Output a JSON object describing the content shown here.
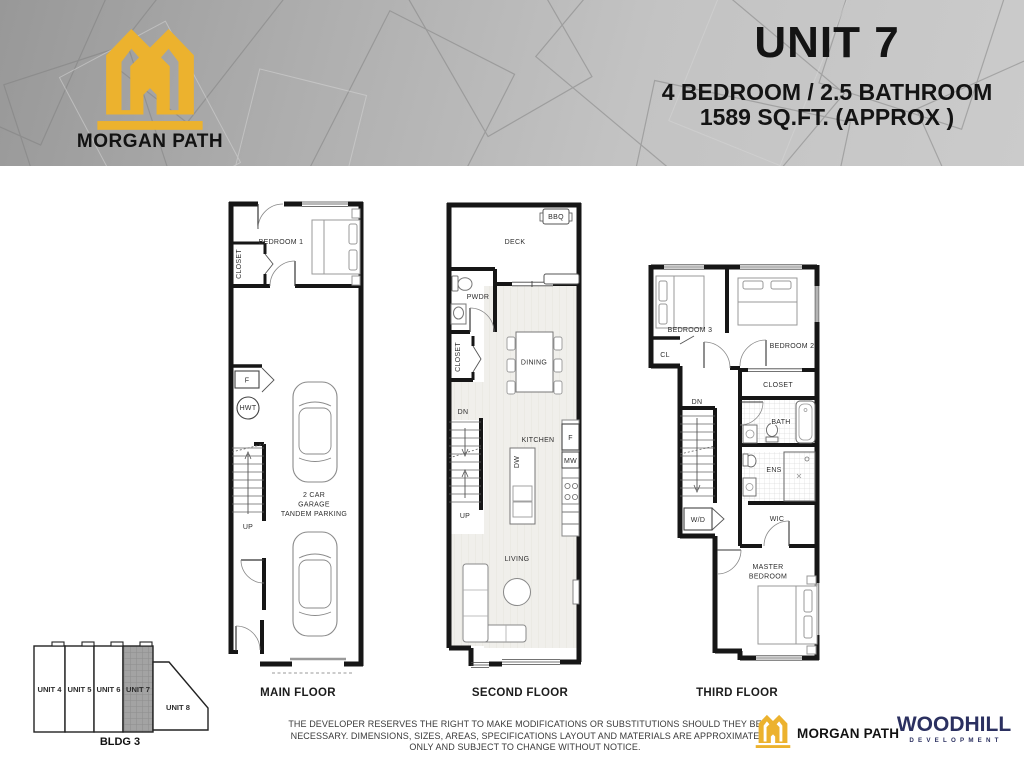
{
  "header": {
    "brand": "MORGAN PATH",
    "unit_title": "UNIT 7",
    "unit_specs": "4 BEDROOM / 2.5 BATHROOM",
    "unit_area": "1589 SQ.FT. (APPROX )"
  },
  "colors": {
    "brand_gold": "#ECB22E",
    "developer_navy": "#2B3060",
    "wall_black": "#161616",
    "floor_gray": "#f0efeb",
    "header_gray": "#b5b5b5"
  },
  "floors": {
    "main": {
      "label": "MAIN FLOOR",
      "bedroom1": "BEDROOM 1",
      "closet": "CLOSET",
      "furnace": "F",
      "hwt": "HWT",
      "up": "UP",
      "garage_line1": "2 CAR",
      "garage_line2": "GARAGE",
      "garage_line3": "TANDEM PARKING"
    },
    "second": {
      "label": "SECOND FLOOR",
      "deck": "DECK",
      "bbq": "BBQ",
      "pwdr": "PWDR",
      "closet": "CLOSET",
      "dining": "DINING",
      "dn": "DN",
      "up": "UP",
      "kitchen": "KITCHEN",
      "dw": "DW",
      "fridge": "F",
      "mw": "MW",
      "living": "LIVING"
    },
    "third": {
      "label": "THIRD FLOOR",
      "bedroom3": "BEDROOM 3",
      "cl": "CL",
      "bedroom2": "BEDROOM 2",
      "closet": "CLOSET",
      "bath": "BATH",
      "dn": "DN",
      "ens": "ENS",
      "wd": "W/D",
      "wic": "WIC",
      "master_line1": "MASTER",
      "master_line2": "BEDROOM"
    }
  },
  "site_key": {
    "units": [
      "UNIT 4",
      "UNIT 5",
      "UNIT 6",
      "UNIT 7"
    ],
    "unit8": "UNIT 8",
    "building": "BLDG 3",
    "highlighted_unit": "UNIT 7"
  },
  "footer": {
    "disclaimer_line1": "THE DEVELOPER RESERVES THE RIGHT TO MAKE MODIFICATIONS OR SUBSTITUTIONS SHOULD THEY BE",
    "disclaimer_line2": "NECESSARY. DIMENSIONS, SIZES, AREAS, SPECIFICATIONS LAYOUT AND MATERIALS ARE APPROXIMATE",
    "disclaimer_line3": "ONLY AND SUBJECT TO CHANGE WITHOUT NOTICE.",
    "brand": "MORGAN PATH",
    "developer_name": "WOODHILL",
    "developer_sub": "DEVELOPMENT"
  }
}
